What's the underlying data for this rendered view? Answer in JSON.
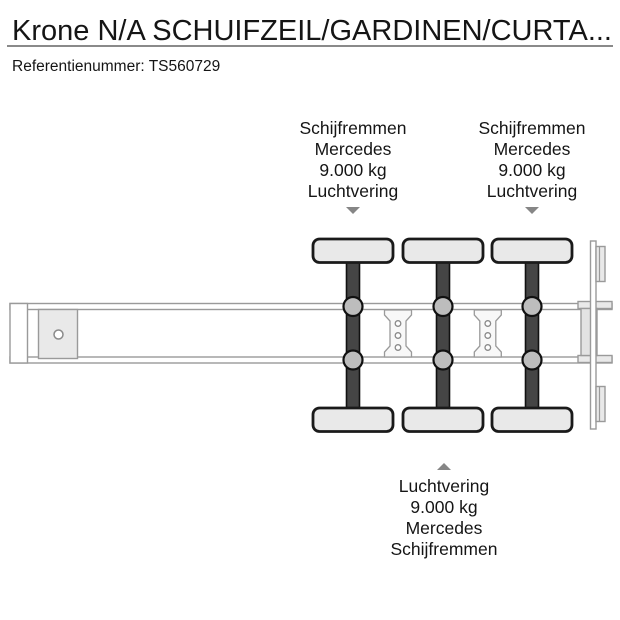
{
  "header": {
    "title": "Krone N/A SCHUIFZEIL/GARDINEN/CURTA...",
    "reference_label": "Referentienummer:",
    "reference_value": "TS560729"
  },
  "annotations": {
    "axle1_top": {
      "lines": [
        "Schijfremmen",
        "Mercedes",
        "9.000 kg",
        "Luchtvering"
      ]
    },
    "axle3_top": {
      "lines": [
        "Schijfremmen",
        "Mercedes",
        "9.000 kg",
        "Luchtvering"
      ]
    },
    "axle2_bottom": {
      "lines": [
        "Luchtvering",
        "9.000 kg",
        "Mercedes",
        "Schijfremmen"
      ]
    }
  },
  "colors": {
    "text_dark": "#151515",
    "rule_gray": "#8a8a8a",
    "line_gray": "#9a9a9a",
    "outline_dark": "#1a1a1a",
    "fill_light": "#e9e9e9",
    "axle_dark": "#454545",
    "susp_gray": "#bdbdbd",
    "arrow_gray": "#868686"
  }
}
